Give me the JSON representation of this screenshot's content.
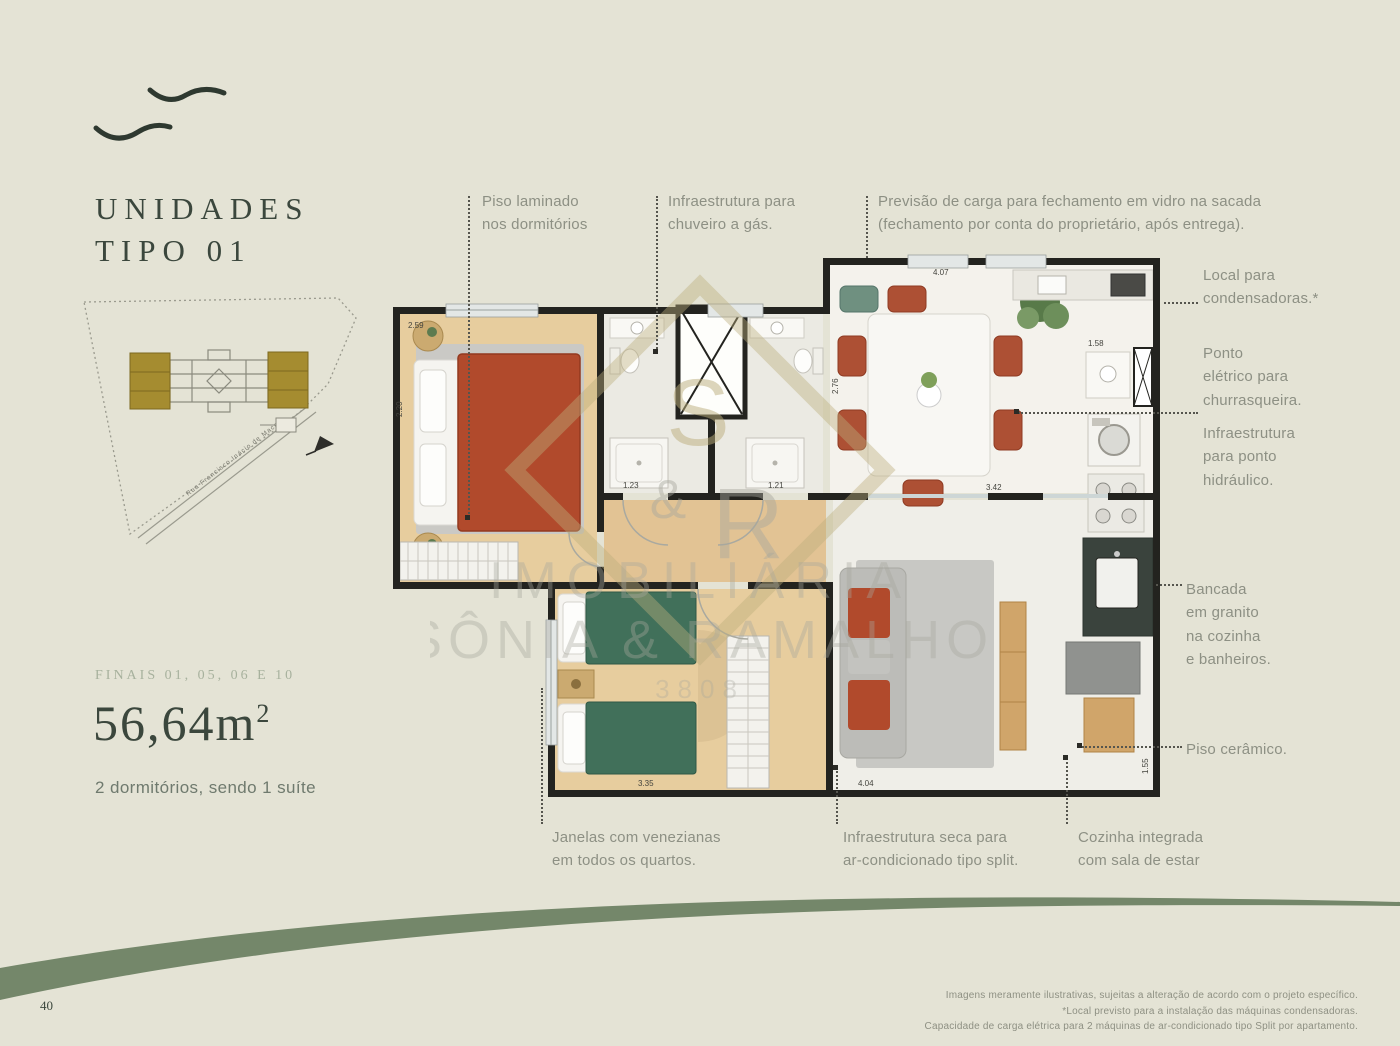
{
  "page": {
    "page_number": "40"
  },
  "header": {
    "title_line1": "UNIDADES",
    "title_line2": "TIPO 01"
  },
  "site_plan": {
    "street_label": "Rua Francisco Inácio de Macedo"
  },
  "unit": {
    "finais": "FINAIS 01, 05, 06 E 10",
    "area": "56,64m",
    "area_sup": "2",
    "description": "2 dormitórios, sendo 1 suíte"
  },
  "callouts": {
    "piso_laminado": "Piso laminado\nnos dormitórios",
    "chuveiro_gas": "Infraestrutura para\nchuveiro a gás.",
    "sacada_vidro": "Previsão de carga para fechamento em vidro na sacada\n(fechamento por conta do proprietário, após entrega).",
    "condensadoras": "Local para\ncondensadoras.*",
    "churrasqueira": "Ponto\nelétrico para\nchurrasqueira.",
    "ponto_hidraulico": "Infraestrutura\npara ponto\nhidráulico.",
    "bancada_granito": "Bancada\nem granito\nna cozinha\ne banheiros.",
    "piso_ceramico": "Piso cerâmico.",
    "janelas_venezianas": "Janelas com venezianas\nem todos os quartos.",
    "ar_condicionado": "Infraestrutura seca para\nar-condicionado tipo split.",
    "cozinha_integrada": "Cozinha integrada\ncom sala de estar"
  },
  "floor_plan": {
    "dimensions": [
      "2.59",
      "2.20",
      "1.23",
      "1.21",
      "4.07",
      "2.76",
      "1.58",
      "3.42",
      "3.35",
      "4.04",
      "1.55"
    ]
  },
  "watermark": {
    "mono_s": "S",
    "mono_amp": "&",
    "mono_r": "R",
    "line1": "IMOBILIÁRIA",
    "line2": "SÔNIA & RAMALHO",
    "line3": "3808"
  },
  "footer": {
    "line1": "Imagens meramente ilustrativas, sujeitas a alteração de acordo com o projeto específico.",
    "line2": "*Local previsto para a instalação das máquinas condensadoras.",
    "line3": "Capacidade de carga elétrica para 2 máquinas de ar-condicionado tipo Split por apartamento."
  }
}
